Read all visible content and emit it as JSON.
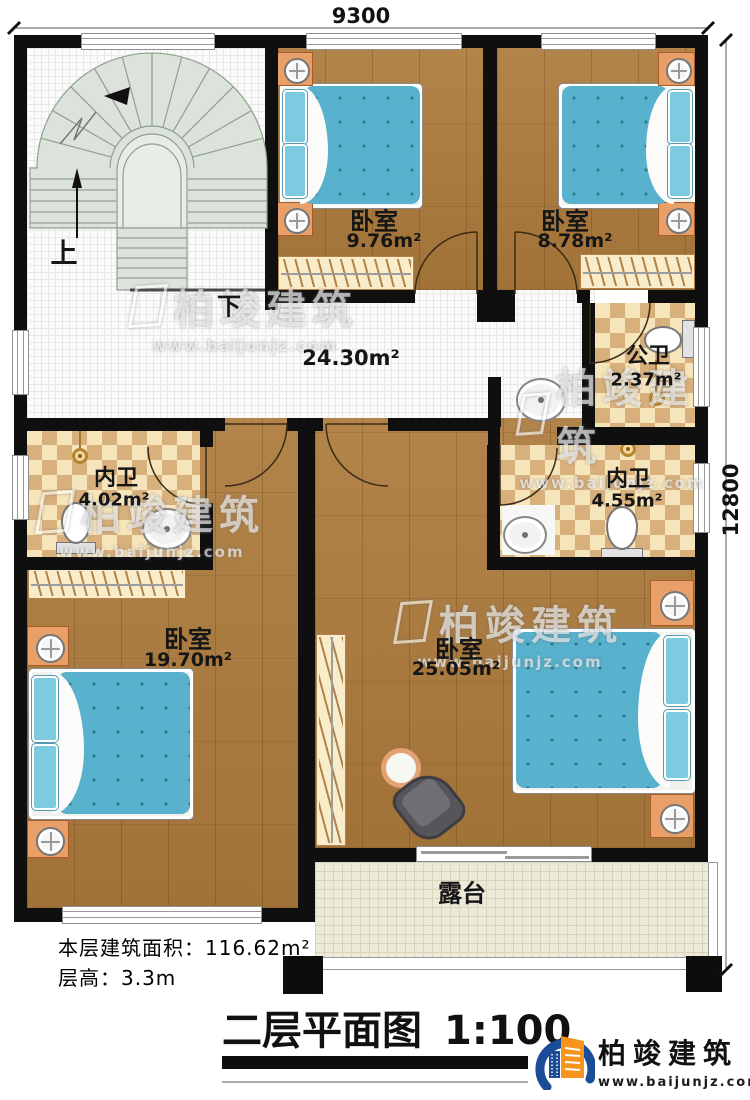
{
  "dimensions": {
    "top": "9300",
    "right": "12800"
  },
  "stair": {
    "up": "上",
    "down": "下"
  },
  "rooms": {
    "bedroom_top_mid": {
      "name": "卧室",
      "area": "9.76m²"
    },
    "bedroom_top_right": {
      "name": "卧室",
      "area": "8.78m²"
    },
    "hallway": {
      "area": "24.30m²"
    },
    "public_bath": {
      "name": "公卫",
      "area": "2.37m²"
    },
    "inner_bath_left": {
      "name": "内卫",
      "area": "4.02m²"
    },
    "inner_bath_right": {
      "name": "内卫",
      "area": "4.55m²"
    },
    "bedroom_left": {
      "name": "卧室",
      "area": "19.70m²"
    },
    "bedroom_right": {
      "name": "卧室",
      "area": "25.05m²"
    },
    "terrace": {
      "name": "露台"
    }
  },
  "footer": {
    "floor_area_label": "本层建筑面积：",
    "floor_area_value": "116.62m²",
    "floor_height_label": "层高：",
    "floor_height_value": "3.3m",
    "title": "二层平面图",
    "scale": "1:100"
  },
  "brand": {
    "name": "柏竣建筑",
    "url": "www.baijunjz.com"
  },
  "watermark": {
    "name": "柏竣建筑",
    "url": "www.baijunjz.com"
  },
  "colors": {
    "wall": "#0f0f0f",
    "wood": "#ad7b3c",
    "bed": "#58b1cd",
    "brand_blue": "#1b4c97",
    "brand_orange": "#f7941d"
  }
}
